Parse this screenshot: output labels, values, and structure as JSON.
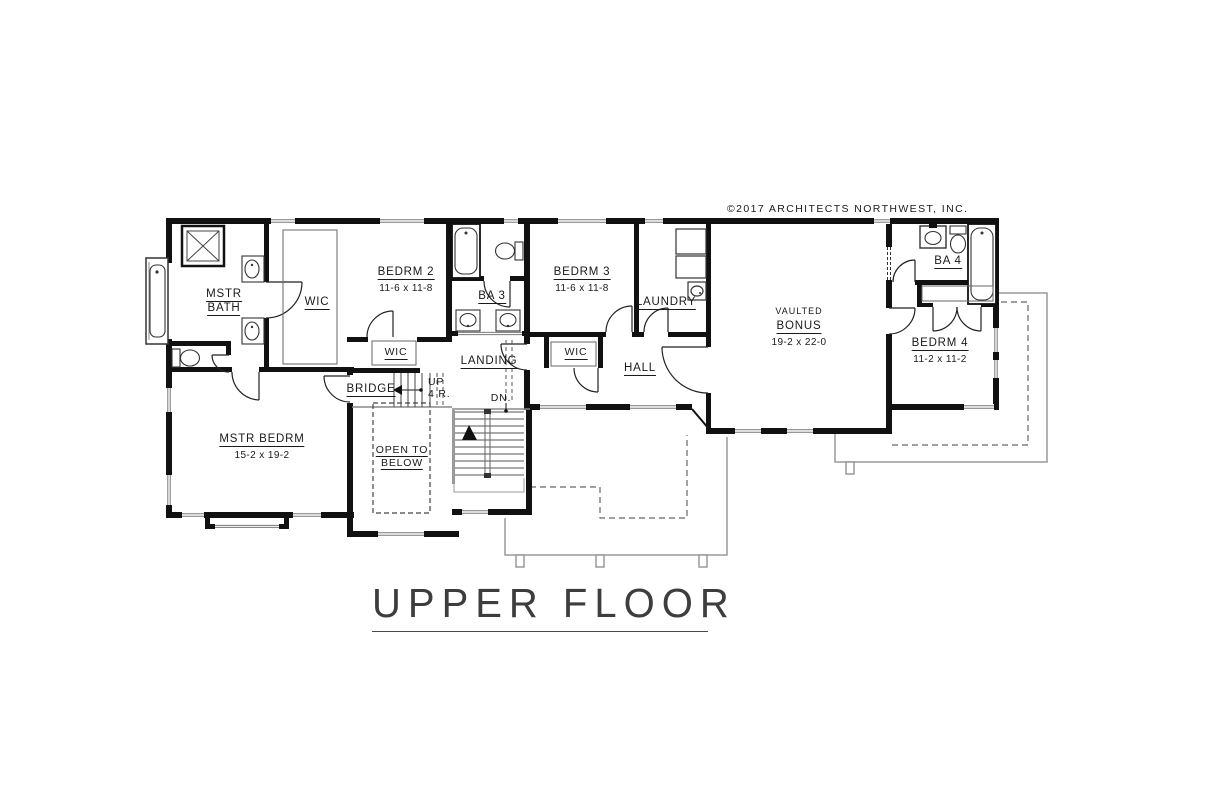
{
  "sheet": {
    "copyright": "©2017 ARCHITECTS NORTHWEST, INC.",
    "title": "UPPER FLOOR"
  },
  "rooms": {
    "mstr_bath": {
      "name_line1": "MSTR",
      "name_line2": "BATH"
    },
    "wic_master": {
      "name": "WIC"
    },
    "bedrm_2": {
      "name": "BEDRM 2",
      "dims": "11-6 x 11-8"
    },
    "ba_3": {
      "name": "BA 3"
    },
    "bedrm_3": {
      "name": "BEDRM 3",
      "dims": "11-6 x 11-8"
    },
    "laundry": {
      "name": "LAUNDRY"
    },
    "bonus": {
      "qualifier": "VAULTED",
      "name": "BONUS",
      "dims": "19-2 x 22-0"
    },
    "ba_4": {
      "name": "BA 4"
    },
    "bedrm_4": {
      "name": "BEDRM 4",
      "dims": "11-2 x 11-2"
    },
    "mstr_bedrm": {
      "name": "MSTR BEDRM",
      "dims": "15-2 x 19-2"
    },
    "wic_bedrm2": {
      "name": "WIC"
    },
    "wic_bedrm3": {
      "name": "WIC"
    },
    "landing": {
      "name": "LANDING"
    },
    "hall": {
      "name": "HALL"
    },
    "bridge": {
      "name": "BRIDGE"
    }
  },
  "stairs": {
    "up_label": "UP",
    "up_risers": "4 R.",
    "down_label": "DN.",
    "open_to_below_line1": "OPEN TO",
    "open_to_below_line2": "BELOW"
  },
  "colors": {
    "walls": "#111111",
    "thin_lines": "#999999",
    "dashed_lines": "#555555",
    "text": "#1a1a1a"
  }
}
